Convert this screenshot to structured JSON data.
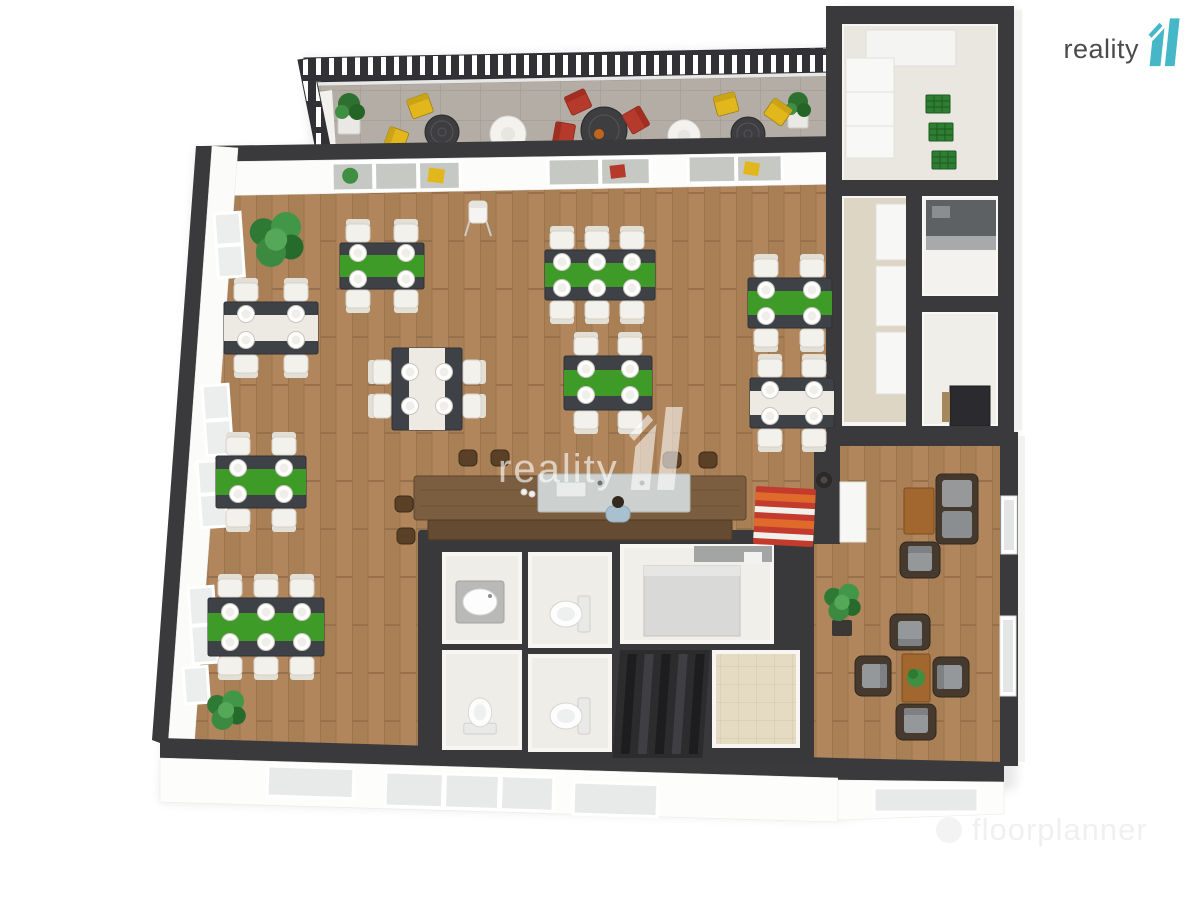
{
  "brand": {
    "name": "reality",
    "numeral": "11",
    "logo_color": "#45b7c7",
    "text_color": "#4b4b4d"
  },
  "center_watermark": {
    "text": "reality",
    "numeral": "11"
  },
  "bottom_watermark": {
    "text": "floorplanner"
  },
  "palette": {
    "wall": "#3a3a3d",
    "wood_floor": "#b1865c",
    "terrace_tile": "#b3ada5",
    "bathroom_tile": "#e5dbc2",
    "table_runner_green": "#3e9b28",
    "table_top_dark": "#3e4247",
    "chair_white": "#f3f1eb",
    "outdoor_chair_yellow": "#e2b71d",
    "outdoor_chair_red": "#b53a2b",
    "bar_wood": "#7b5d3f",
    "sofa_frame": "#453a2d",
    "crate_green": "#2e7d32"
  }
}
